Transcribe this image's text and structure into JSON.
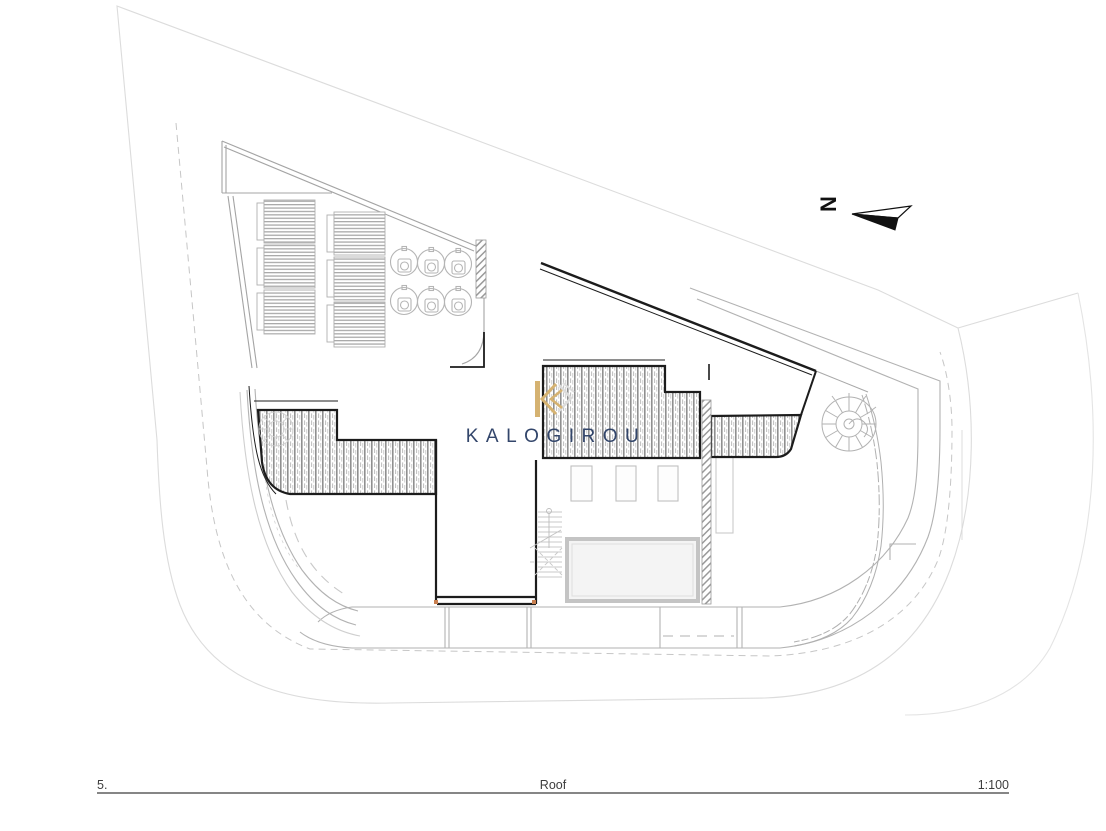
{
  "title_block": {
    "sheet_number": "5.",
    "sheet_title": "Roof",
    "scale": "1:100"
  },
  "north_arrow": {
    "label": "N"
  },
  "watermark": {
    "brand": "KALOGIROU",
    "gold_color": "#D5B271",
    "navy_color": "#33466B"
  },
  "plan": {
    "kind": "roof plan drawing",
    "features": [
      "site-boundary",
      "setback-dashed-line",
      "solar-panel-array",
      "solar-water-heaters",
      "roof-deck-hatched",
      "spiral-staircase",
      "straight-staircase",
      "skylights",
      "roof-pool",
      "planter-hedge",
      "balcony-below-outline",
      "north-arrow"
    ]
  },
  "colors": {
    "outline_black": "#1c1c1c",
    "parapet_gray": "#9a9a9a",
    "light_gray": "#c6c6c6",
    "faint_gray": "#dcdcdc",
    "accent_dot": "#c87f4f"
  }
}
